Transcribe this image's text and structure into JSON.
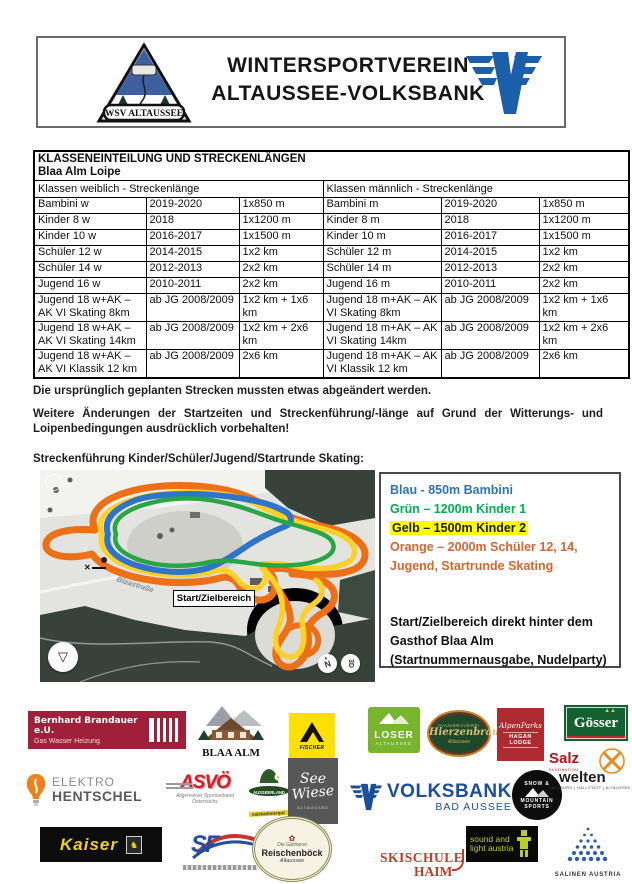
{
  "header": {
    "org_line1": "WINTERSPORTVEREIN",
    "org_line2": "ALTAUSSEE-VOLKSBANK",
    "wsv_banner": "WSV ALTAUSSEE"
  },
  "table": {
    "title": "KLASSENEINTEILUNG UND STRECKENLÄNGEN",
    "subtitle": "Blaa Alm Loipe",
    "group_headers": [
      "Klassen weiblich - Streckenlänge",
      "Klassen männlich - Streckenlänge"
    ],
    "rows": [
      [
        "Bambini w",
        "2019-2020",
        "1x850 m",
        "Bambini m",
        "2019-2020",
        "1x850 m"
      ],
      [
        "Kinder 8 w",
        "2018",
        "1x1200 m",
        "Kinder 8 m",
        "2018",
        "1x1200 m"
      ],
      [
        "Kinder 10 w",
        "2016-2017",
        "1x1500 m",
        "Kinder 10 m",
        "2016-2017",
        "1x1500 m"
      ],
      [
        "Schüler 12 w",
        "2014-2015",
        "1x2 km",
        "Schüler 12 m",
        "2014-2015",
        "1x2 km"
      ],
      [
        "Schüler 14 w",
        "2012-2013",
        "2x2 km",
        "Schüler 14 m",
        "2012-2013",
        "2x2 km"
      ],
      [
        "Jugend 16 w",
        "2010-2011",
        "2x2 km",
        "Jugend 16 m",
        "2010-2011",
        "2x2 km"
      ],
      [
        "Jugend 18 w+AK – AK VI Skating 8km",
        "ab JG 2008/2009",
        "1x2 km + 1x6 km",
        "Jugend 18 m+AK – AK VI Skating 8km",
        "ab JG 2008/2009",
        "1x2 km + 1x6 km"
      ],
      [
        "Jugend 18 w+AK – AK VI Skating 14km",
        "ab JG 2008/2009",
        "1x2 km + 2x6 km",
        "Jugend 18 m+AK – AK VI Skating 14km",
        "ab JG 2008/2009",
        "1x2 km + 2x6 km"
      ],
      [
        "Jugend 18 w+AK – AK VI Klassik 12 km",
        "ab JG 2008/2009",
        "2x6 km",
        "Jugend 18 m+AK – AK VI Klassik 12 km",
        "ab JG 2008/2009",
        "2x6 km"
      ]
    ]
  },
  "paragraphs": {
    "p1": "Die ursprünglich geplanten Strecken mussten etwas abgeändert werden.",
    "p2": "Weitere Änderungen der Startzeiten und Streckenführung/-länge auf Grund der Witterungs- und Loipenbedingungen ausdrücklich vorbehalten!",
    "p3": "Streckenführung Kinder/Schüler/Jugend/Startrunde Skating:"
  },
  "map": {
    "start_label": "Start/Zielbereich",
    "road_label": "Blaastraße",
    "compass_label": "N",
    "mode_label": "3D",
    "track_colors": {
      "orange": "#ee7016",
      "yellow": "#fdd02a",
      "blue": "#2e74c9",
      "green": "#2aa546"
    }
  },
  "legend": {
    "items": [
      {
        "text": "Blau - 850m Bambini",
        "color": "#2e75b6",
        "highlight": ""
      },
      {
        "text": "Grün – 1200m Kinder 1",
        "color": "#00b050",
        "highlight": ""
      },
      {
        "text": "Gelb – 1500m Kinder 2",
        "color": "#1a1a1a",
        "highlight": "#ffff00"
      },
      {
        "text": "Orange – 2000m Schüler 12, 14, Jugend, Startrunde Skating",
        "color": "#d9642e",
        "highlight": ""
      }
    ],
    "note": "Start/Zielbereich direkt hinter dem Gasthof Blaa Alm (Startnummernausgabe, Nudelparty)"
  },
  "sponsors": {
    "brandauer": {
      "line1": "Bernhard Brandauer e.U.",
      "line2": "Gas Wasser Heizung"
    },
    "blaa_alm": {
      "label": "BLAA ALM"
    },
    "fischer": {
      "label": "FISCHER"
    },
    "loser": {
      "line1": "LOSER",
      "line2": "ALTAUSSEE"
    },
    "hierzenbrau": {
      "line0": "HAUSBRAUEREI",
      "line1": "Hierzenbrau",
      "line2": "Altaussee"
    },
    "hagan_lodge": {
      "line1": "AlpenParks",
      "line2": "HAGAN LODGE"
    },
    "goesser": {
      "label": "Gösser"
    },
    "hentschel": {
      "line1": "ELEKTRO",
      "line2": "HENTSCHEL"
    },
    "asvo": {
      "label": "ASVÖ",
      "caption1": "Allgemeiner Sportverband",
      "caption2": "Österreichs"
    },
    "ausseerland": {
      "label": "AUSSEERLAND",
      "ribbon": "salzkammergut"
    },
    "seewiese": {
      "line1": "See",
      "line2": "Wiese",
      "caption": "ALTAUSSEE"
    },
    "volksbank": {
      "line1": "VOLKSBANK",
      "line2": "BAD AUSSEE"
    },
    "snow_mountain": {
      "line1": "SNOW &",
      "line2": "MOUNTAIN",
      "line3": "SPORTS"
    },
    "salzwelten": {
      "line1": "Salz",
      "sub": "FASZINATION",
      "line2": "welten",
      "caption": "SALZBURG | HALLSTATT | ALTAUSSEE"
    },
    "kaiser": {
      "label": "Kaiser"
    },
    "sf": {
      "label": "SF"
    },
    "reischenboeck": {
      "arc": "Die Gärtnerei",
      "line1": "Reischenböck",
      "line2": "Altaussee"
    },
    "skischule_haim": {
      "line1": "SKISCHULE",
      "line2": "HAIM"
    },
    "sound_light": {
      "line1": "sound and",
      "line2": "light austria"
    },
    "salinen": {
      "label": "SALINEN AUSTRIA"
    }
  }
}
